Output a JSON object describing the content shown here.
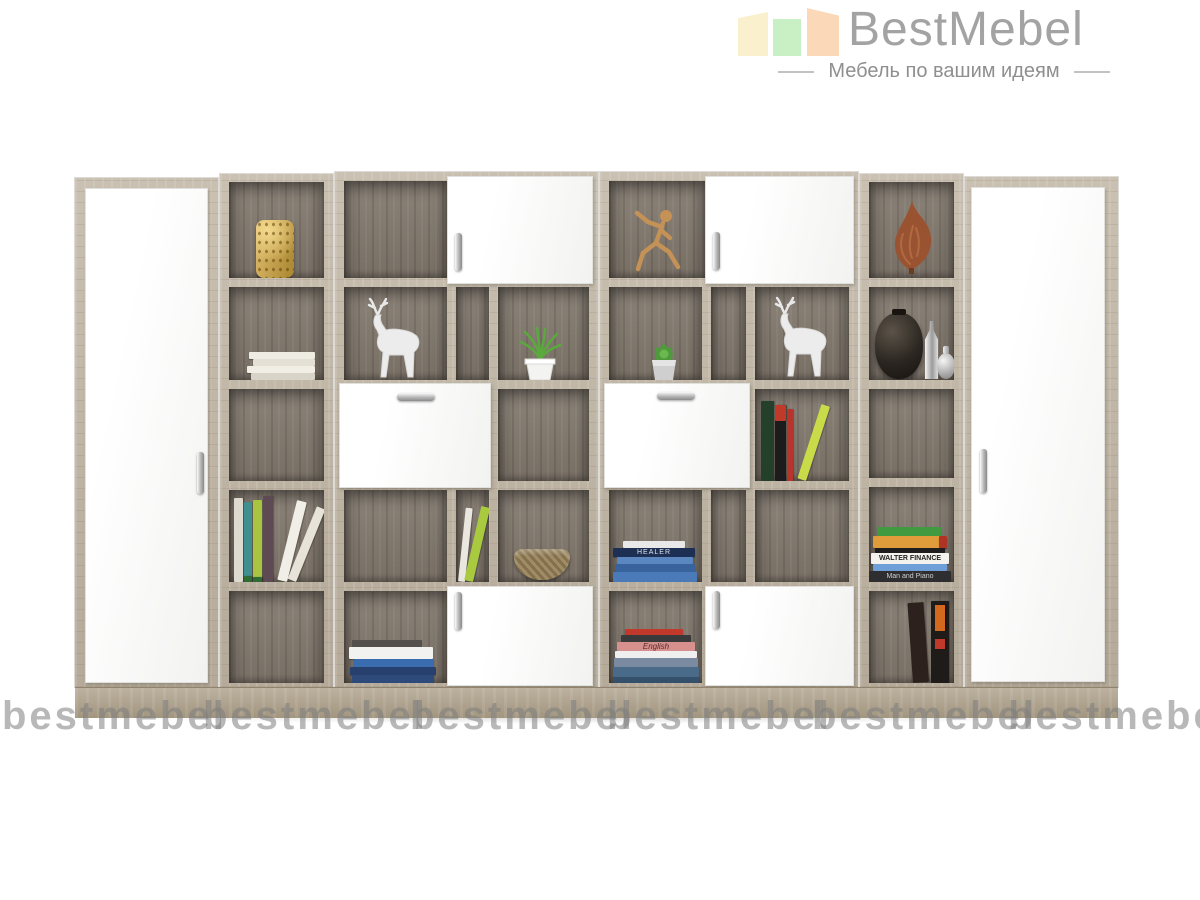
{
  "brand": {
    "name": "BestMebel",
    "tagline": "Мебель по вашим идеям",
    "text_color": "#a3a3a3",
    "bar_colors": [
      "#fbf0cd",
      "#c9efc4",
      "#fbd9b8"
    ]
  },
  "watermark": {
    "text": "bestmebel",
    "count": 6
  },
  "palette": {
    "frame_wood": "#c0b6a7",
    "interior_wood": "#81786d",
    "door_white": "#fafafa",
    "plinth_wood": "#b1a695",
    "handle_chrome": "#b5b5b5"
  },
  "furniture": {
    "description": "Modular wall bookcase: two white wardrobe doors at the ends, oak-grey frame, open shelf cubes with white hinged and flap doors",
    "sections": {
      "left_wardrobe": "tall-white-door-with-chrome-handle",
      "column_a_cells": [
        "gold-perforated-vase",
        "white-book-stack",
        "empty",
        "colorful-standing-books",
        "empty"
      ],
      "module_b_cells": [
        "open-cube + white-door",
        "deer-figurine | empty | grass-plant",
        "white-flap-door + empty-cube",
        "empty | leaning-green-book | wicker-bowl",
        "book-stack + white-door"
      ],
      "module_c_cells": [
        "running-man-figure + white-door",
        "succulent-pot | empty | deer-figurine",
        "white-flap-door + leaning-books",
        "blue-book-stack | empty | empty",
        "colorful-book-stack + white-door"
      ],
      "column_d_cells": [
        "copper-flame-sculpture",
        "black-vase-with-silver-bottles",
        "empty",
        "finance-book-stack",
        "two-standing-dark-books"
      ],
      "right_wardrobe": "tall-white-door-with-chrome-handle"
    },
    "spines": {
      "healer": "HEALER",
      "walter": "WALTER FINANCE",
      "man_and_piano": "Man and Piano",
      "english": "English"
    }
  }
}
